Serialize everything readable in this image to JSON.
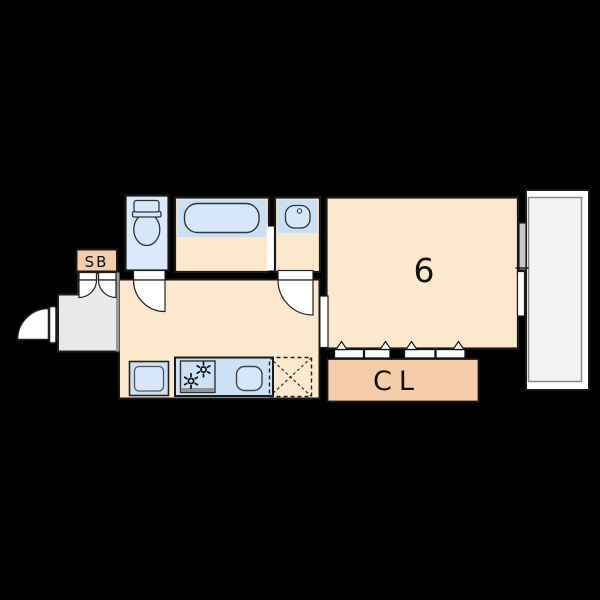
{
  "plan": {
    "labels": {
      "shoe_box": "SB",
      "main_room": "6",
      "closet": "CL"
    },
    "colors": {
      "background": "#000000",
      "wall_outline": "#1a1a1a",
      "floor": "#fce9cd",
      "storage_fill": "#f6cdab",
      "wet_zone": "#cadff4",
      "counter": "#cde1f6",
      "fixture": "#d6e7f9",
      "toilet_room": "#dbe9fb",
      "entrance_floor": "#e9e9e9",
      "balcony_floor": "#f3f3f3",
      "door_white": "#ffffff",
      "step_line": "#999999"
    },
    "icons": [
      "toilet-icon",
      "bathtub-icon",
      "washbasin-icon",
      "stove-icon",
      "burner-icon",
      "kitchen-sink-icon",
      "washing-machine-icon",
      "refrigerator-placeholder-icon",
      "entrance-door-icon",
      "toilet-door-icon",
      "washroom-door-icon",
      "double-door-icon",
      "closet-folding-door-icon",
      "sliding-window-icon"
    ]
  }
}
